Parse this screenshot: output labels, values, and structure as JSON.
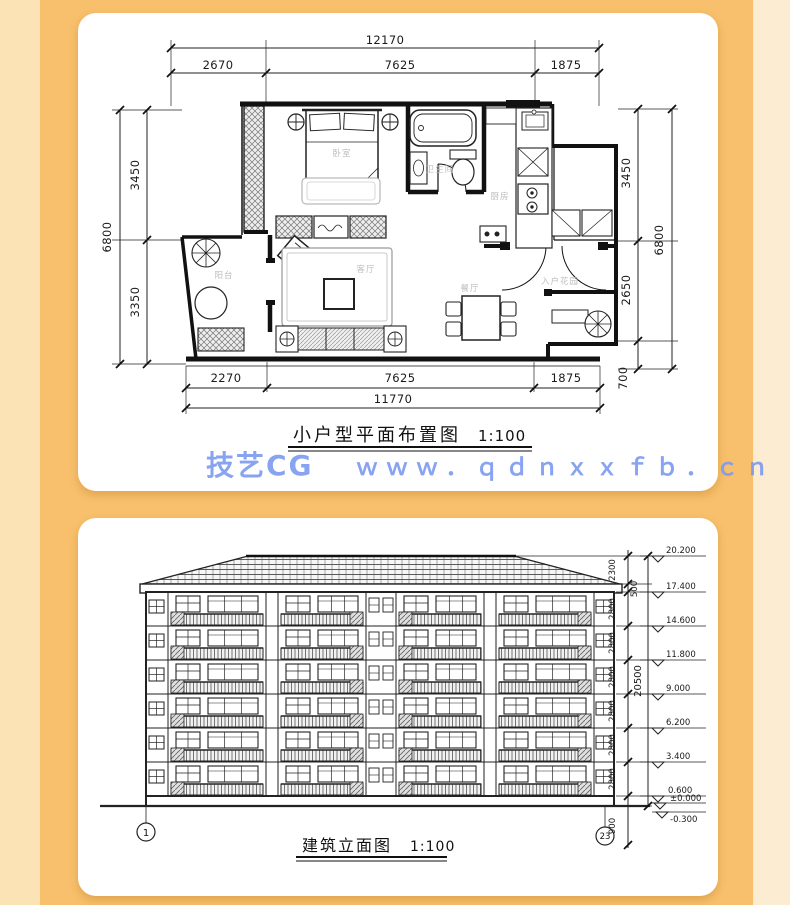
{
  "watermark": {
    "brand": "技艺CG",
    "url": "ｗｗｗ．ｑｄｎｘｘｆｂ．ｃｎ"
  },
  "colors": {
    "accent_orange": "#f8c06c",
    "panel_light_left": "#fbe3b6",
    "panel_light_right": "#fcedd2",
    "watermark_blue": "#7d9cf0",
    "card_white": "#ffffff",
    "drawing_line": "#1a1a1a"
  },
  "floor_plan": {
    "title": "小户型平面布置图",
    "scale": "1:100",
    "dims": {
      "top_total": "12170",
      "top": [
        "2670",
        "7625",
        "1875"
      ],
      "left_total": "6800",
      "left": [
        "3450",
        "3350"
      ],
      "right_total": "6800",
      "right": [
        "3450",
        "2650",
        "700"
      ],
      "bottom_total": "11770",
      "bottom": [
        "2270",
        "7625",
        "1875"
      ]
    },
    "rooms": {
      "bedroom": "卧室",
      "living": "客厅",
      "dining": "餐厅",
      "kitchen": "厨房",
      "bath": "卫生间",
      "balcony": "阳台",
      "entry": "入户花园"
    }
  },
  "elevation": {
    "title": "建筑立面图",
    "scale": "1:100",
    "levels": [
      "20.200",
      "17.400",
      "14.600",
      "11.800",
      "9.000",
      "6.200",
      "3.400",
      "0.600",
      "±0.000",
      "-0.300"
    ],
    "dims": [
      "2300",
      "500",
      "2800",
      "2800",
      "2800",
      "2800",
      "2800",
      "2800",
      "900"
    ],
    "total": "20500",
    "axis_markers": [
      "1",
      "23"
    ]
  }
}
